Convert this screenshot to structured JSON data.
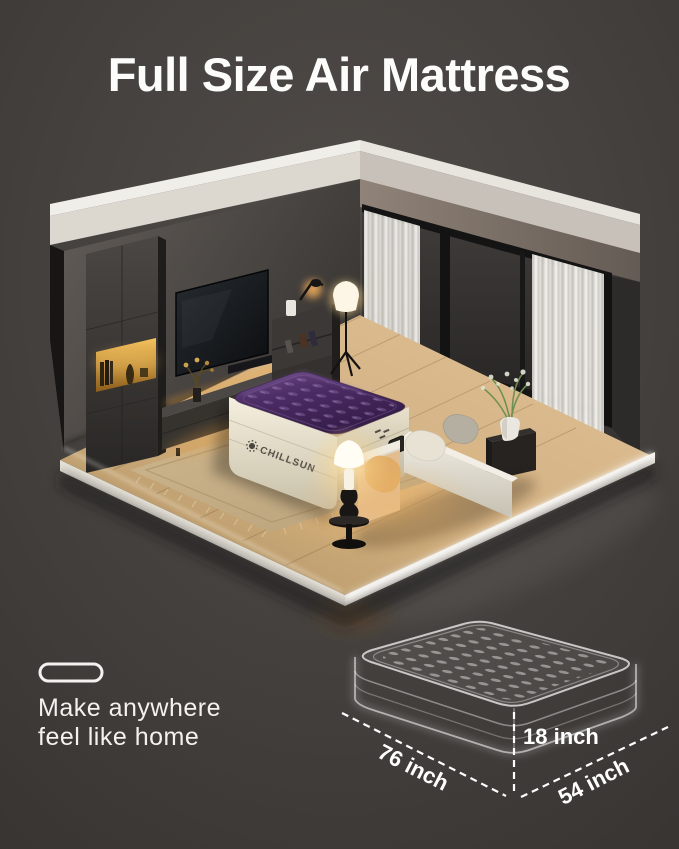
{
  "page": {
    "title": "Full Size Air Mattress"
  },
  "product": {
    "brand": "CHILLSUN"
  },
  "tagline": {
    "line1": "Make anywhere",
    "line2": "feel like home"
  },
  "dimensions": {
    "length_label": "76 inch",
    "height_label": "18 inch",
    "width_label": "54 inch"
  },
  "colors": {
    "background": "#45413e",
    "title_text": "#fcfcfb",
    "mattress_top_purple": "#4b2b63",
    "mattress_base_cream": "#e9e2d0",
    "wood_floor": "#d4b487",
    "warm_glow": "#f2b768",
    "trim_white": "#dcd7cf"
  }
}
